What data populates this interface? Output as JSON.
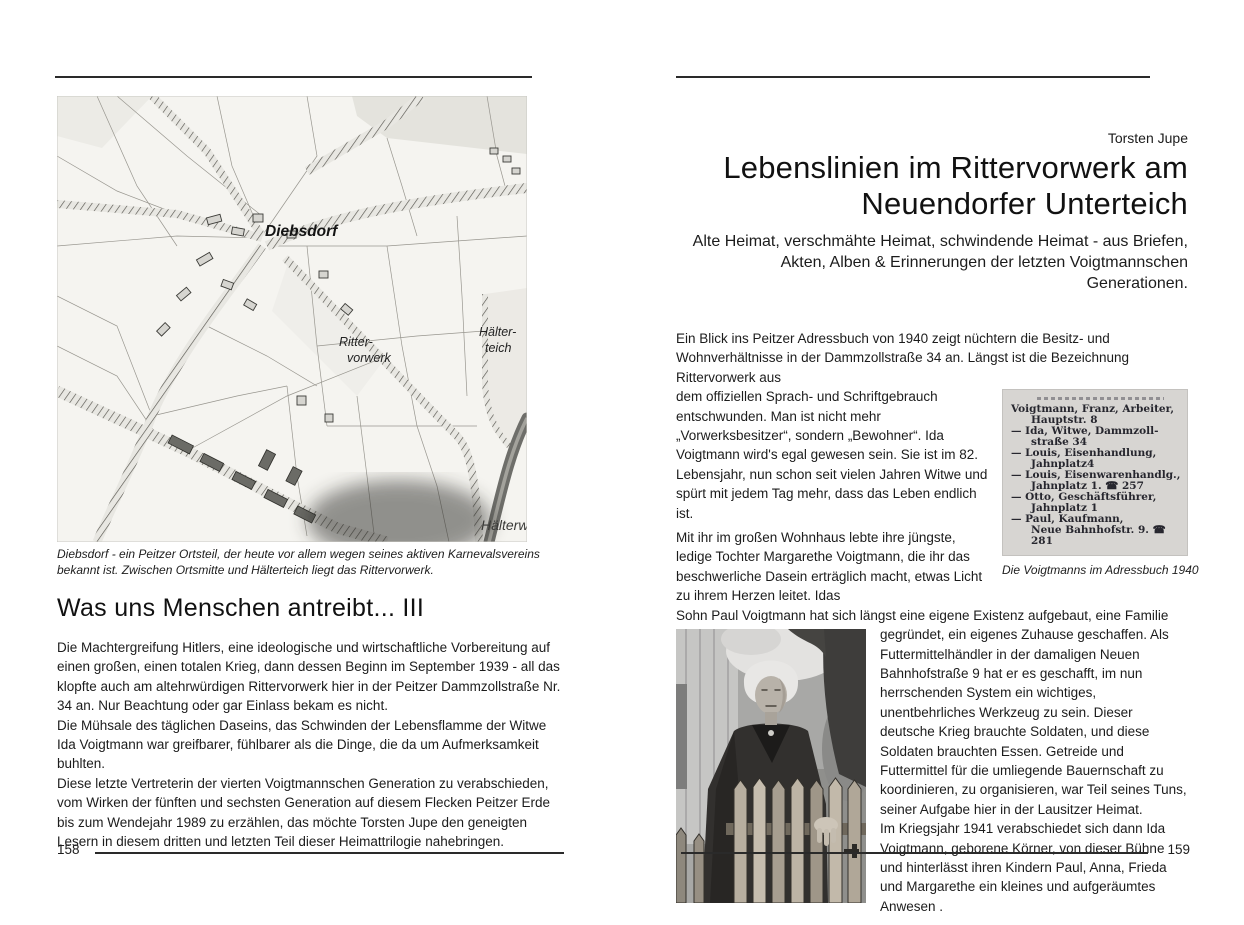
{
  "colors": {
    "page_bg": "#ffffff",
    "text": "#1c1c1c",
    "rule": "#2a2a2a",
    "addressbook_bg": "#d7d5d2",
    "map_bg": "#f5f4f0"
  },
  "left_page": {
    "page_number": "158",
    "map_labels": {
      "town": "Diebsdorf",
      "vorwerk_l1": "Ritter-",
      "vorwerk_l2": "vorwerk",
      "teich_l1": "Hälter-",
      "teich_l2": "teich",
      "partial": "Hälterw"
    },
    "map_caption": "Diebsdorf - ein Peitzer Ortsteil, der heute vor allem wegen seines aktiven Karnevalsvereins bekannt ist. Zwischen Ortsmitte und Hälterteich liegt das Rittervorwerk.",
    "heading": "Was uns Menschen antreibt... III",
    "paragraphs": [
      "Die Machtergreifung Hitlers, eine ideologische und wirtschaftliche Vorbereitung auf einen großen, einen totalen Krieg, dann dessen Beginn im September 1939 - all das klopfte auch am altehrwürdigen Rittervorwerk hier in der Peitzer Dammzollstraße Nr. 34 an. Nur Beachtung oder gar Einlass bekam es nicht.",
      "Die Mühsale des täglichen Daseins, das Schwinden der Lebensflamme der Witwe Ida Voigtmann war greifbarer, fühlbarer als die Dinge, die da um Aufmerksamkeit buhlten.",
      "Diese letzte Vertreterin der vierten Voigtmannschen Generation zu verabschieden, vom Wirken der fünften und sechsten Generation auf diesem Flecken Peitzer Erde bis zum Wendejahr 1989 zu erzählen, das möchte Torsten Jupe den geneigten Lesern in diesem dritten und letzten Teil dieser Heimattrilogie nahebringen."
    ]
  },
  "right_page": {
    "page_number": "159",
    "author": "Torsten Jupe",
    "title_l1": "Lebenslinien im Rittervorwerk am",
    "title_l2": "Neuendorfer Unterteich",
    "subtitle": "Alte Heimat, verschmähte Heimat, schwindende Heimat - aus Briefen, Akten, Alben & Erinnerungen der letzten Voigtmannschen Generationen.",
    "para1a": "Ein Blick ins Peitzer Adressbuch von 1940 zeigt nüchtern die Besitz- und Wohnverhältnisse in der Dammzollstraße 34 an. Längst ist die Bezeichnung Rittervorwerk aus",
    "para1b": "dem offiziellen Sprach- und Schriftgebrauch entschwunden. Man ist nicht mehr „Vorwerksbesitzer“, sondern „Bewohner“. Ida Voigtmann wird's egal gewesen sein. Sie ist im 82. Lebensjahr, nun schon seit vielen Jahren Witwe und spürt mit jedem Tag mehr, dass das Leben endlich ist.",
    "para2": "Mit ihr im großen Wohnhaus lebte ihre jüngste, ledige Tochter Margarethe Voigtmann, die ihr das beschwerliche Dasein erträglich macht, etwas Licht zu ihrem Herzen leitet. Idas",
    "para3a": "Sohn Paul Voigtmann hat sich längst eine eigene Existenz aufgebaut, eine Familie",
    "para3b": "gegründet, ein eigenes Zuhause geschaffen. Als Futtermittelhändler in der damaligen Neuen Bahnhofstraße 9 hat er es geschafft, im nun herrschenden System ein wichtiges, unentbehrliches Werkzeug zu sein. Dieser deutsche Krieg brauchte Soldaten, und diese Soldaten brauchten Essen. Getreide und Futtermittel für die umliegende Bauernschaft zu koordinieren, zu organisieren, war Teil seines Tuns, seiner Aufgabe hier in der Lausitzer Heimat.",
    "para4": "Im Kriegsjahr 1941 verabschiedet sich dann Ida Voigtmann, geborene Körner, von dieser Bühne und hinterlässt ihren Kindern Paul, Anna, Frieda und Margarethe ein kleines und aufgeräumtes Anwesen .",
    "addressbook": {
      "entries": [
        {
          "prefix": "",
          "l1": "Voigtmann, Franz, Arbeiter,",
          "l2": "Hauptstr. 8"
        },
        {
          "prefix": "— ",
          "l1": "Ida, Witwe, Dammzoll-",
          "l2": "straße 34"
        },
        {
          "prefix": "— ",
          "l1": "Louis, Eisenhandlung,",
          "l2": "Jahnplatz4"
        },
        {
          "prefix": "— ",
          "l1": "Louis, Eisenwarenhandlg.,",
          "l2": "Jahnplatz 1. ☎ 257"
        },
        {
          "prefix": "— ",
          "l1": "Otto, Geschäftsführer,",
          "l2": "Jahnplatz 1"
        },
        {
          "prefix": "— ",
          "l1": "Paul, Kaufmann,",
          "l2": "Neue Bahnhofstr. 9. ☎ 281"
        }
      ],
      "caption": "Die Voigtmanns im Adressbuch 1940"
    },
    "photo_caption": "Ida Voigtmann, geb. Körner, lächelt noch einmal"
  }
}
